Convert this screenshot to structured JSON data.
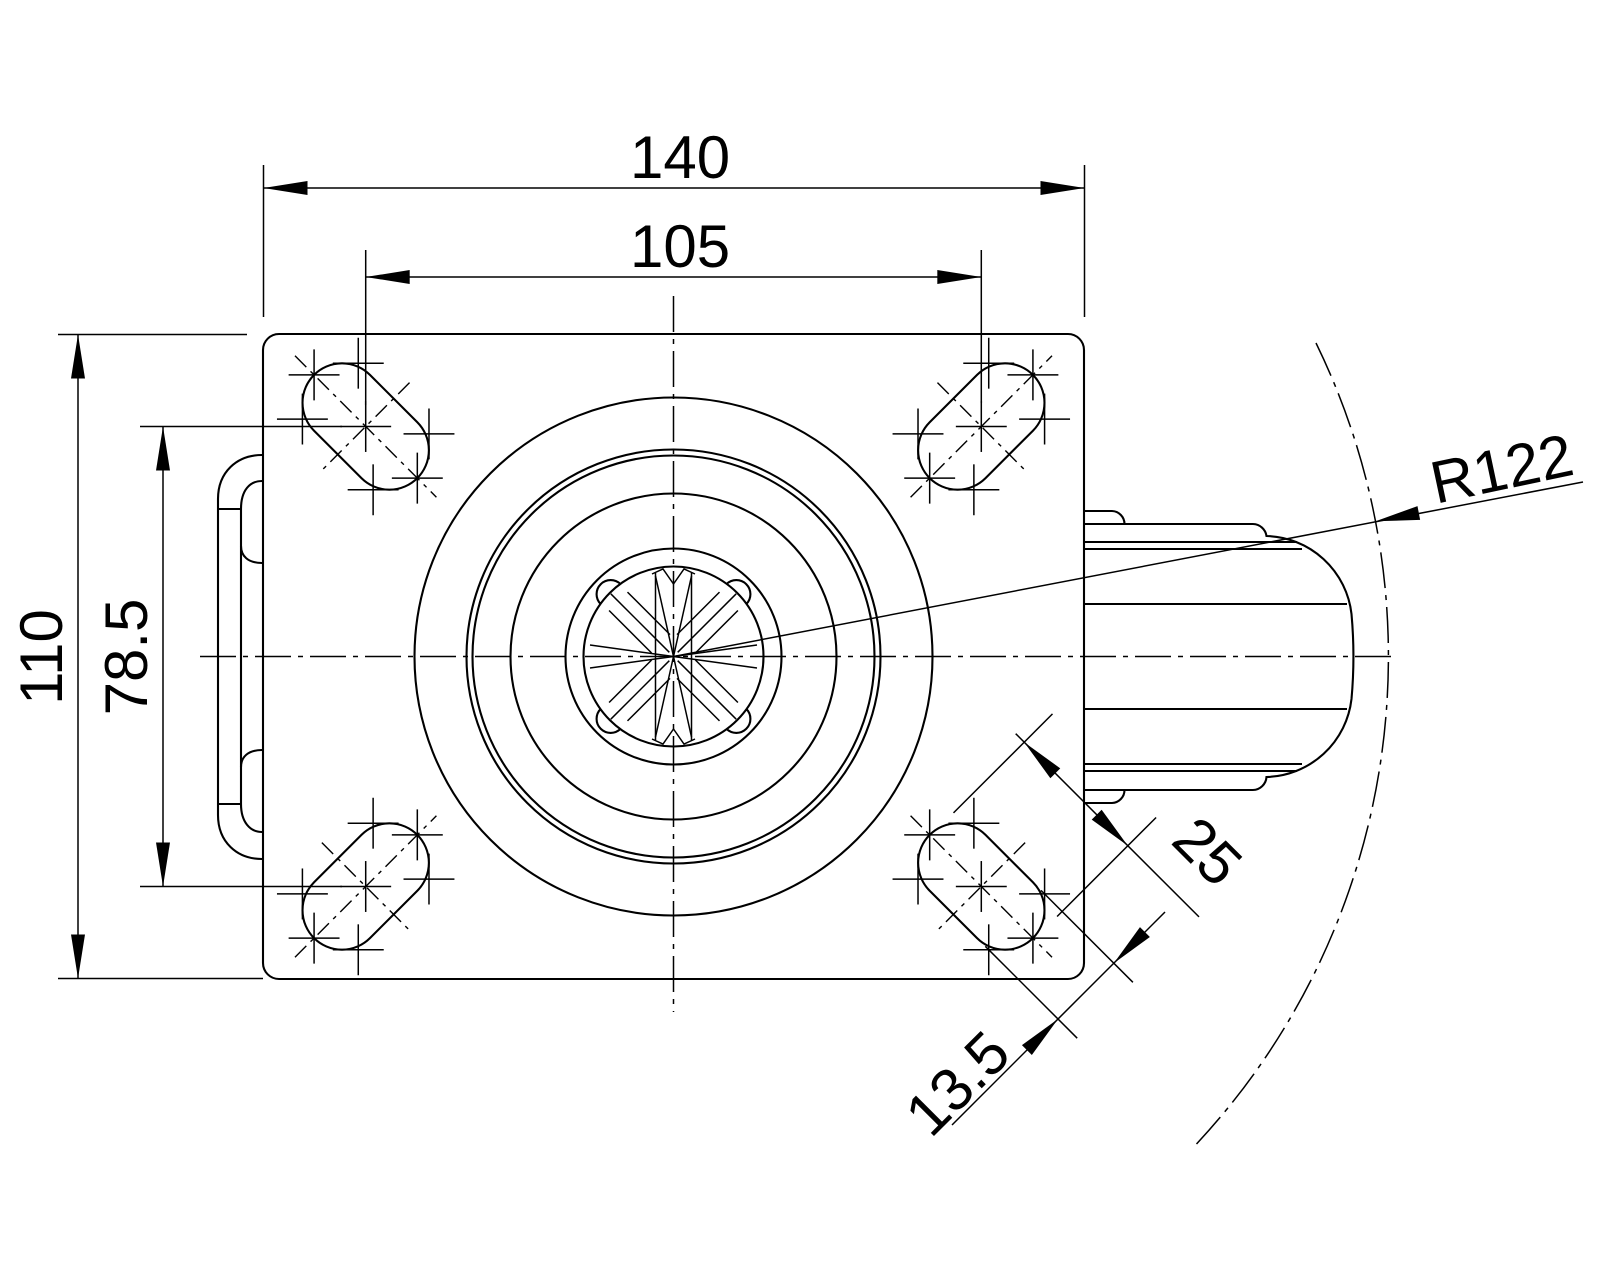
{
  "drawing": {
    "type": "technical-drawing",
    "view": "caster-top-view",
    "background_color": "#ffffff",
    "line_color": "#000000",
    "labels": {
      "plate_width": "140",
      "hole_spacing_x": "105",
      "plate_height": "110",
      "hole_spacing_y": "78.5",
      "swivel_radius": "R122",
      "slot_length": "25",
      "slot_width": "13.5"
    }
  }
}
